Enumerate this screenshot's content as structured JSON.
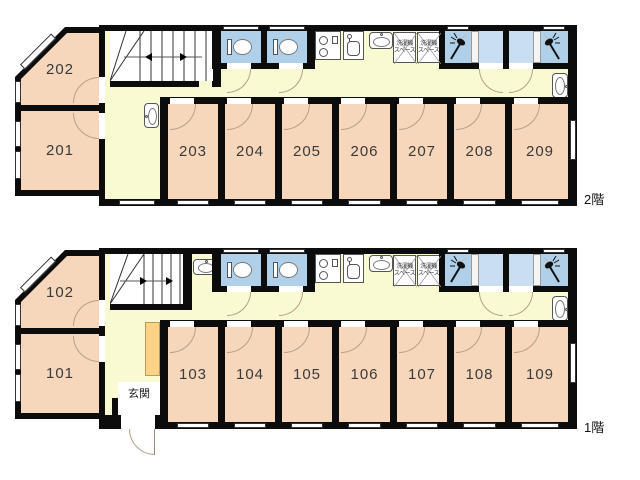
{
  "floors": [
    {
      "name": "2F",
      "floor_label": "2階",
      "left_rooms": [
        {
          "label": "202"
        },
        {
          "label": "201"
        }
      ],
      "rooms": [
        {
          "label": "203"
        },
        {
          "label": "204"
        },
        {
          "label": "205"
        },
        {
          "label": "206"
        },
        {
          "label": "207"
        },
        {
          "label": "208"
        },
        {
          "label": "209"
        }
      ],
      "washer_spaces": {
        "line1": "洗濯機",
        "line2": "スペース"
      }
    },
    {
      "name": "1F",
      "floor_label": "1階",
      "left_rooms": [
        {
          "label": "102"
        },
        {
          "label": "101"
        }
      ],
      "rooms": [
        {
          "label": "103"
        },
        {
          "label": "104"
        },
        {
          "label": "105"
        },
        {
          "label": "106"
        },
        {
          "label": "107"
        },
        {
          "label": "108"
        },
        {
          "label": "109"
        }
      ],
      "washer_spaces": {
        "line1": "洗濯機",
        "line2": "スペース"
      },
      "entrance_label": "玄関"
    }
  ],
  "icons": {
    "stairs-icon": "staircase treads with direction arrows",
    "toilet-icon": "toilet plan symbol",
    "stove-icon": "two-burner stove",
    "kitchen-sink-icon": "kitchen sink with faucet",
    "washbasin-icon": "oval washbasin with faucet",
    "shower-icon": "shower head with spray",
    "washer-space-icon": "crossed box reserved for washing machine",
    "door-arc-icon": "door swing arc",
    "window-icon": "double-line window"
  },
  "colors": {
    "wall": "#0c0c0c",
    "room_fill": "#f6d7bb",
    "hallway_fill": "#fafad2",
    "wet_area_fill": "#afd0e8",
    "wet_entry_fill": "#cadef1",
    "cabinet_fill": "#fcd287",
    "door_arc": "#b3a08a",
    "background": "#ffffff"
  }
}
